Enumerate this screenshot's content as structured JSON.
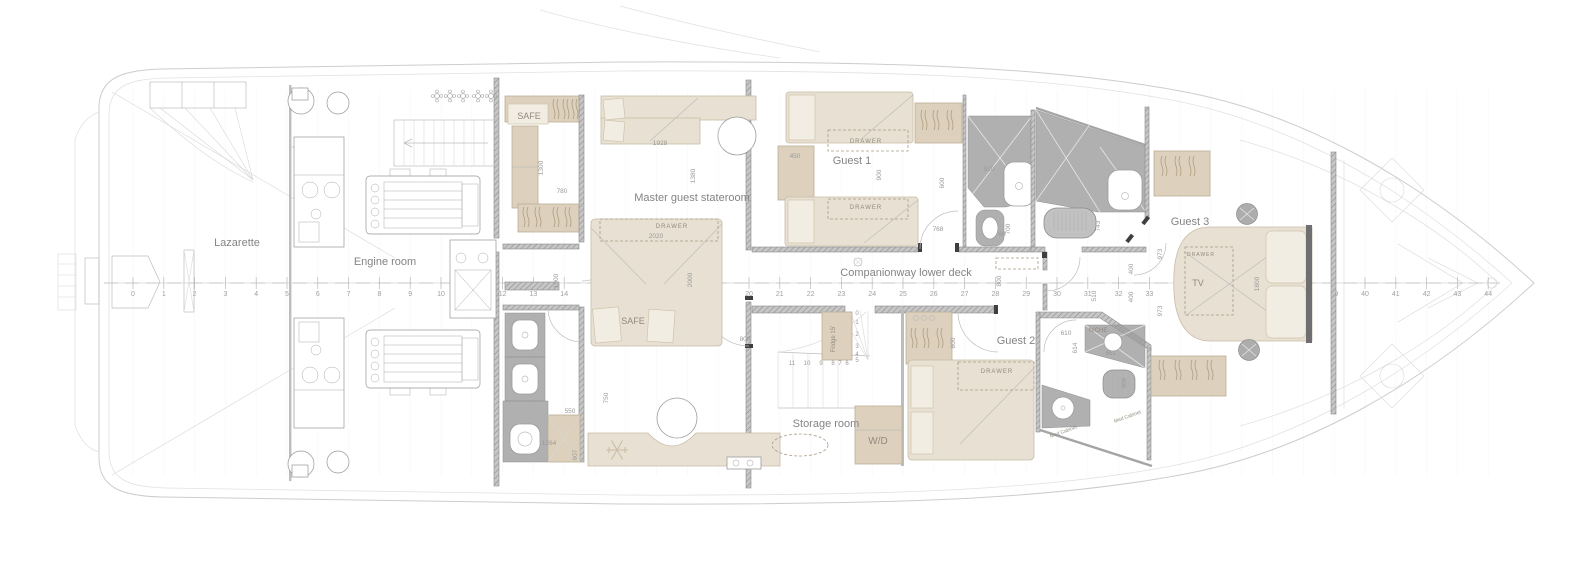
{
  "title": "Yacht lower deck floor plan",
  "rooms": {
    "lazarette": "Lazarette",
    "engine_room": "Engine room",
    "master": "Master guest stateroom",
    "guest1": "Guest 1",
    "guest2": "Guest 2",
    "guest3": "Guest 3",
    "companionway": "Companionway lower deck",
    "storage": "Storage room"
  },
  "features": {
    "safe_closet": "SAFE",
    "safe_master": "SAFE",
    "wd": "W/D",
    "tv": "TV",
    "niche": "NICHE",
    "fridge": "Fridge 15'",
    "drawer": "DRAWER",
    "med_cabinet": "Med Cabinet"
  },
  "dims": [
    "1300",
    "780",
    "1000",
    "1928",
    "1380",
    "2020",
    "2000",
    "800",
    "750",
    "550",
    "1264",
    "607",
    "450",
    "900",
    "600",
    "510",
    "768",
    "700",
    "68",
    "743",
    "973",
    "973",
    "400",
    "400",
    "510",
    "800",
    "1800",
    "800",
    "610",
    "614",
    "661",
    "509"
  ],
  "ruler": {
    "frames": [
      "0",
      "1",
      "2",
      "3",
      "4",
      "5",
      "6",
      "7",
      "8",
      "9",
      "10",
      "11",
      "12",
      "13",
      "14",
      "15",
      "16",
      "17",
      "18",
      "19",
      "20",
      "21",
      "22",
      "23",
      "24",
      "25",
      "26",
      "27",
      "28",
      "29",
      "30",
      "31",
      "32",
      "33",
      "34",
      "35",
      "36",
      "37",
      "38",
      "39",
      "40",
      "41",
      "42",
      "43",
      "44"
    ]
  },
  "stairs": {
    "run_steps": [
      "11",
      "10",
      "9",
      "8",
      "7",
      "6"
    ],
    "winder_steps": [
      "0",
      "1",
      "2",
      "3",
      "4",
      "5"
    ]
  },
  "colors": {
    "furniture_beige": "#e8e0d2",
    "wet_area_gray": "#9e9e9e",
    "wall_gray": "#8c8c8c",
    "line_gray": "#cdcdcd",
    "text_gray": "#8a8a8a"
  }
}
